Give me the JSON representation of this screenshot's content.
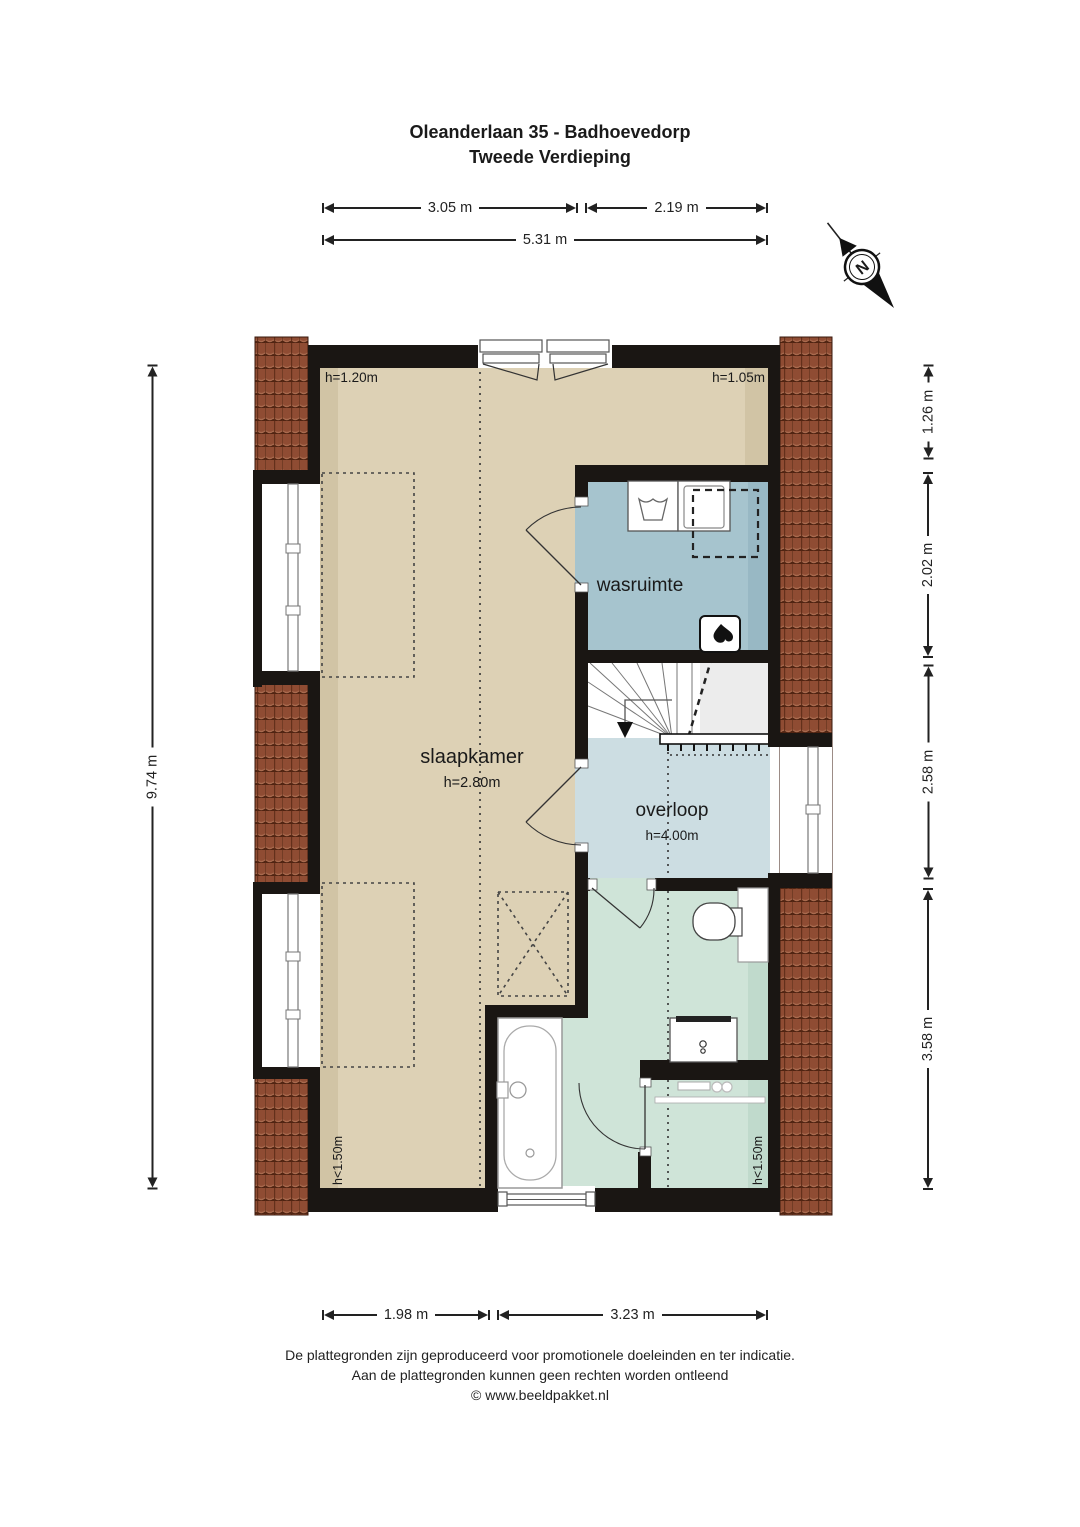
{
  "title": {
    "line1": "Oleanderlaan 35 - Badhoevedorp",
    "line2": "Tweede Verdieping"
  },
  "dimensions": {
    "top_left": "3.05 m",
    "top_right": "2.19 m",
    "top_total": "5.31 m",
    "side_left": "9.74 m",
    "right_1": "1.26 m",
    "right_2": "2.02 m",
    "right_3": "2.58 m",
    "right_4": "3.58 m",
    "bottom_left": "1.98 m",
    "bottom_right": "3.23 m"
  },
  "rooms": {
    "slaapkamer": {
      "name": "slaapkamer",
      "ceiling": "h=2.80m"
    },
    "wasruimte": {
      "name": "wasruimte"
    },
    "overloop": {
      "name": "overloop",
      "ceiling": "h=4.00m"
    }
  },
  "height_labels": {
    "top_left": "h=1.20m",
    "top_right": "h=1.05m",
    "bottom_left": "h<1.50m",
    "bottom_right": "h<1.50m"
  },
  "compass": {
    "label": "N"
  },
  "footer": {
    "line1": "De plattegronden zijn geproduceerd voor promotionele doeleinden en ter indicatie.",
    "line2": "Aan de plattegronden kunnen geen rechten worden ontleend",
    "line3": "© www.beeldpakket.nl"
  },
  "colors": {
    "bedroom": "#ddd1b5",
    "bedroom_shade": "#d1c4a5",
    "laundry": "#a6c4ce",
    "laundry_shade": "#98b8c4",
    "landing": "#ccdde2",
    "bathroom": "#cfe4d8",
    "bathroom_shade": "#c0dacc",
    "stairs_shade": "#ececec",
    "roof_tile": "#8f4c33",
    "wall": "#1a1613"
  }
}
